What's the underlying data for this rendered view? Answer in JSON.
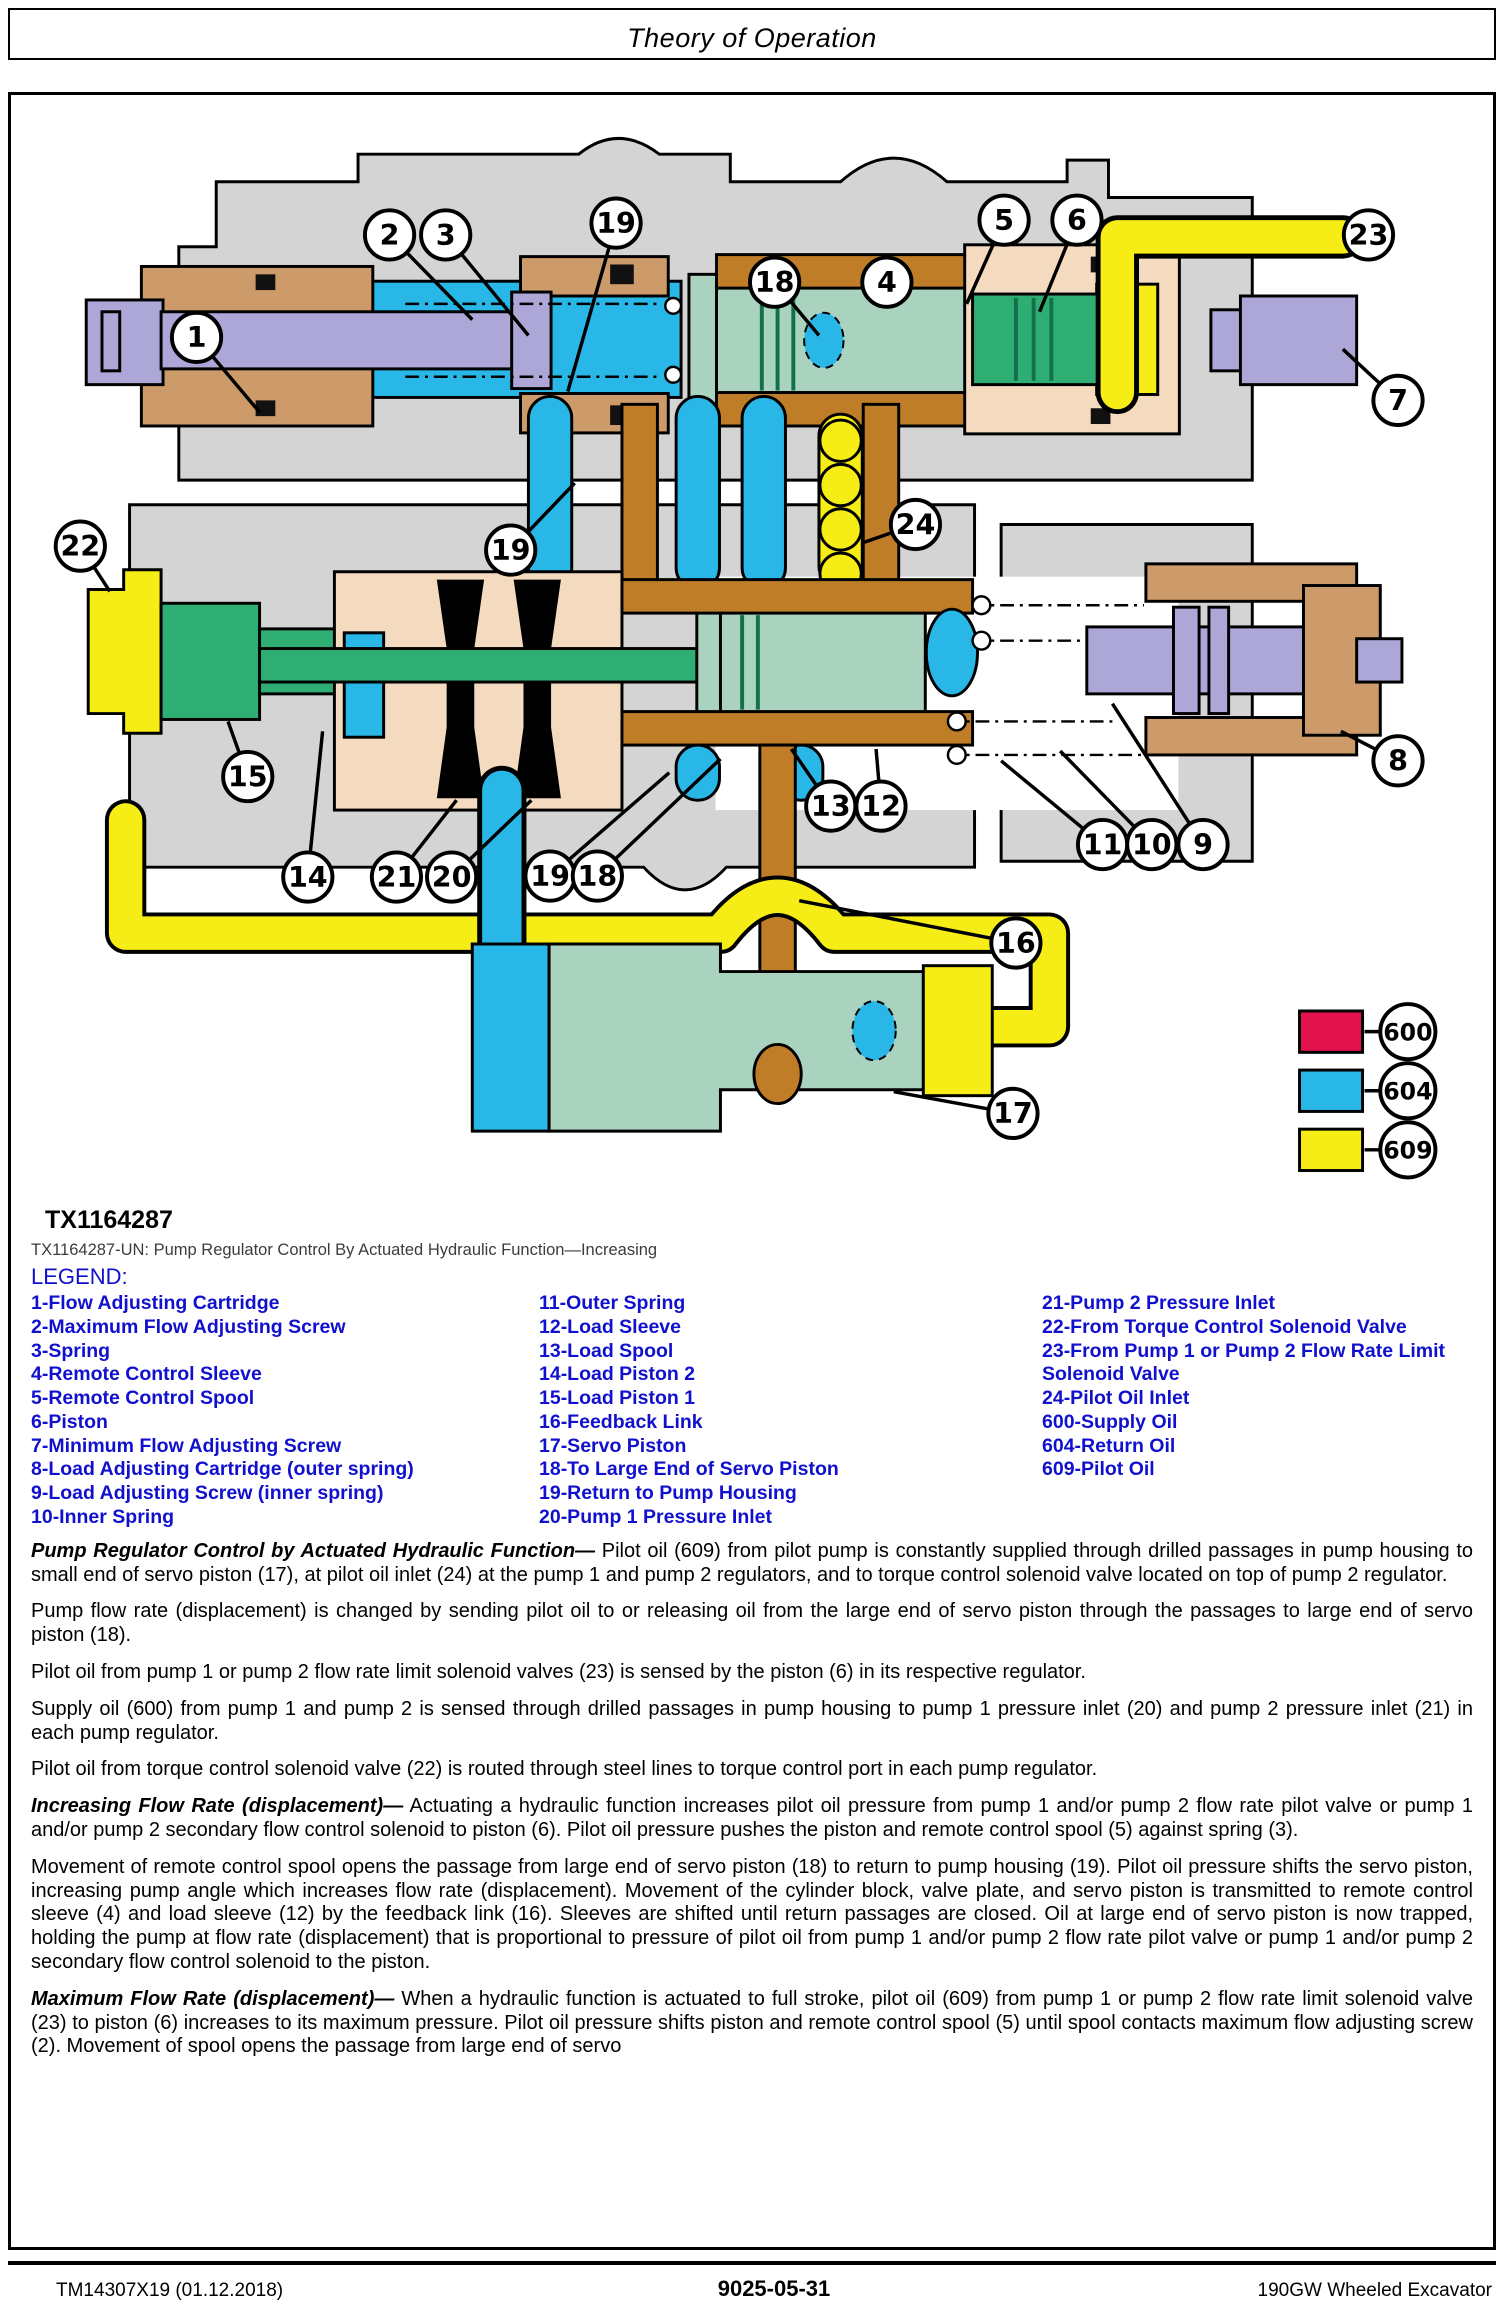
{
  "page": {
    "header_title": "Theory of Operation",
    "figure_id": "TX1164287",
    "figure_caption": "TX1164287-UN: Pump Regulator Control By Actuated Hydraulic Function—Increasing",
    "legend_title": "LEGEND:"
  },
  "legend": {
    "col1": [
      "1-Flow Adjusting Cartridge",
      "2-Maximum Flow Adjusting Screw",
      "3-Spring",
      "4-Remote Control Sleeve",
      "5-Remote Control Spool",
      "6-Piston",
      "7-Minimum Flow Adjusting Screw",
      "8-Load Adjusting Cartridge (outer spring)",
      "9-Load Adjusting Screw (inner spring)",
      "10-Inner Spring"
    ],
    "col2": [
      "11-Outer Spring",
      "12-Load Sleeve",
      "13-Load Spool",
      "14-Load Piston 2",
      "15-Load Piston 1",
      "16-Feedback Link",
      "17-Servo Piston",
      "18-To Large End of Servo Piston",
      "19-Return to Pump Housing",
      "20-Pump 1 Pressure Inlet"
    ],
    "col3": [
      "21-Pump 2 Pressure Inlet",
      "22-From Torque Control Solenoid Valve",
      "23-From Pump 1 or Pump 2 Flow Rate Limit Solenoid Valve",
      "24-Pilot Oil Inlet",
      "600-Supply Oil",
      "604-Return Oil",
      "609-Pilot Oil"
    ]
  },
  "paragraphs": [
    {
      "lead": "Pump Regulator Control by Actuated Hydraulic Function—",
      "text": " Pilot oil (609) from pilot pump is constantly supplied through drilled passages in pump housing to small end of servo piston (17), at pilot oil inlet (24) at the pump 1 and pump 2 regulators, and to torque control solenoid valve located on top of pump 2 regulator."
    },
    {
      "lead": "",
      "text": "Pump flow rate (displacement) is changed by sending pilot oil to or releasing oil from the large end of servo piston through the passages to large end of servo piston (18)."
    },
    {
      "lead": "",
      "text": "Pilot oil from pump 1 or pump 2 flow rate limit solenoid valves (23) is sensed by the piston (6) in its respective regulator."
    },
    {
      "lead": "",
      "text": "Supply oil (600) from pump 1 and pump 2 is sensed through drilled passages in pump housing to pump 1 pressure inlet (20) and pump 2 pressure inlet (21) in each pump regulator."
    },
    {
      "lead": "",
      "text": "Pilot oil from torque control solenoid valve (22) is routed through steel lines to torque control port in each pump regulator."
    },
    {
      "lead": "Increasing Flow Rate (displacement)—",
      "text": " Actuating a hydraulic function increases pilot oil pressure from pump 1 and/or pump 2 flow rate pilot valve or pump 1 and/or pump 2 secondary flow control solenoid to piston (6). Pilot oil pressure pushes the piston and remote control spool (5) against spring (3)."
    },
    {
      "lead": "",
      "text": "Movement of remote control spool opens the passage from large end of servo piston (18) to return to pump housing (19). Pilot oil pressure shifts the servo piston, increasing pump angle which increases flow rate (displacement). Movement of the cylinder block, valve plate, and servo piston is transmitted to remote control sleeve (4) and load sleeve (12) by the feedback link (16). Sleeves are shifted until return passages are closed. Oil at large end of servo piston is now trapped, holding the pump at flow rate (displacement) that is proportional to pressure of pilot oil from pump 1 and/or pump 2 flow rate pilot valve or pump 1 and/or pump 2 secondary flow control solenoid to the piston."
    },
    {
      "lead": "Maximum Flow Rate (displacement)—",
      "text": " When a hydraulic function is actuated to full stroke, pilot oil (609) from pump 1 or pump 2 flow rate limit solenoid valve (23) to piston (6) increases to its maximum pressure. Pilot oil pressure shifts piston and remote control spool (5) until spool contacts maximum flow adjusting screw (2). Movement of spool opens the passage from large end of servo"
    }
  ],
  "footer": {
    "left": "TM14307X19 (01.12.2018)",
    "center": "9025-05-31",
    "right": "190GW Wheeled Excavator"
  },
  "diagram": {
    "colors": {
      "supply_oil": "#E3114C",
      "return_oil": "#29B7E8",
      "pilot_oil": "#F6EC16"
    },
    "color_key": [
      {
        "label": "600",
        "meaning": "Supply Oil"
      },
      {
        "label": "604",
        "meaning": "Return Oil"
      },
      {
        "label": "609",
        "meaning": "Pilot Oil"
      }
    ],
    "callouts": [
      {
        "label": "1",
        "x": 168,
        "y": 240,
        "tx": 232,
        "ty": 316
      },
      {
        "label": "2",
        "x": 364,
        "y": 136,
        "tx": 448,
        "ty": 222
      },
      {
        "label": "3",
        "x": 421,
        "y": 136,
        "tx": 505,
        "ty": 238
      },
      {
        "label": "19",
        "x": 594,
        "y": 124,
        "tx": 545,
        "ty": 295
      },
      {
        "label": "18",
        "x": 755,
        "y": 184,
        "tx": 800,
        "ty": 238
      },
      {
        "label": "4",
        "x": 869,
        "y": 184,
        "tx": 893,
        "ty": 178
      },
      {
        "label": "5",
        "x": 988,
        "y": 121,
        "tx": 950,
        "ty": 206
      },
      {
        "label": "6",
        "x": 1062,
        "y": 121,
        "tx": 1024,
        "ty": 214
      },
      {
        "label": "23",
        "x": 1358,
        "y": 136,
        "tx": 1334,
        "ty": 136
      },
      {
        "label": "7",
        "x": 1388,
        "y": 304,
        "tx": 1332,
        "ty": 252
      },
      {
        "label": "22",
        "x": 50,
        "y": 452,
        "tx": 80,
        "ty": 498
      },
      {
        "label": "19",
        "x": 487,
        "y": 456,
        "tx": 552,
        "ty": 388
      },
      {
        "label": "24",
        "x": 898,
        "y": 430,
        "tx": 846,
        "ty": 448
      },
      {
        "label": "15",
        "x": 220,
        "y": 686,
        "tx": 200,
        "ty": 630
      },
      {
        "label": "14",
        "x": 281,
        "y": 788,
        "tx": 296,
        "ty": 640
      },
      {
        "label": "21",
        "x": 371,
        "y": 788,
        "tx": 432,
        "ty": 710
      },
      {
        "label": "20",
        "x": 427,
        "y": 788,
        "tx": 508,
        "ty": 710
      },
      {
        "label": "19",
        "x": 527,
        "y": 787,
        "tx": 648,
        "ty": 682
      },
      {
        "label": "18",
        "x": 575,
        "y": 787,
        "tx": 700,
        "ty": 668
      },
      {
        "label": "13",
        "x": 812,
        "y": 716,
        "tx": 772,
        "ty": 658
      },
      {
        "label": "12",
        "x": 863,
        "y": 716,
        "tx": 858,
        "ty": 658
      },
      {
        "label": "11",
        "x": 1088,
        "y": 755,
        "tx": 985,
        "ty": 670
      },
      {
        "label": "10",
        "x": 1138,
        "y": 755,
        "tx": 1045,
        "ty": 660
      },
      {
        "label": "9",
        "x": 1190,
        "y": 755,
        "tx": 1098,
        "ty": 612
      },
      {
        "label": "8",
        "x": 1388,
        "y": 670,
        "tx": 1330,
        "ty": 640
      },
      {
        "label": "16",
        "x": 1000,
        "y": 855,
        "tx": 780,
        "ty": 812
      },
      {
        "label": "17",
        "x": 997,
        "y": 1028,
        "tx": 876,
        "ty": 1006
      },
      {
        "label": "600",
        "x": 1398,
        "y": 945,
        "tx": 1354,
        "ty": 945
      },
      {
        "label": "604",
        "x": 1398,
        "y": 1005,
        "tx": 1354,
        "ty": 1005
      },
      {
        "label": "609",
        "x": 1398,
        "y": 1065,
        "tx": 1354,
        "ty": 1065
      }
    ]
  }
}
